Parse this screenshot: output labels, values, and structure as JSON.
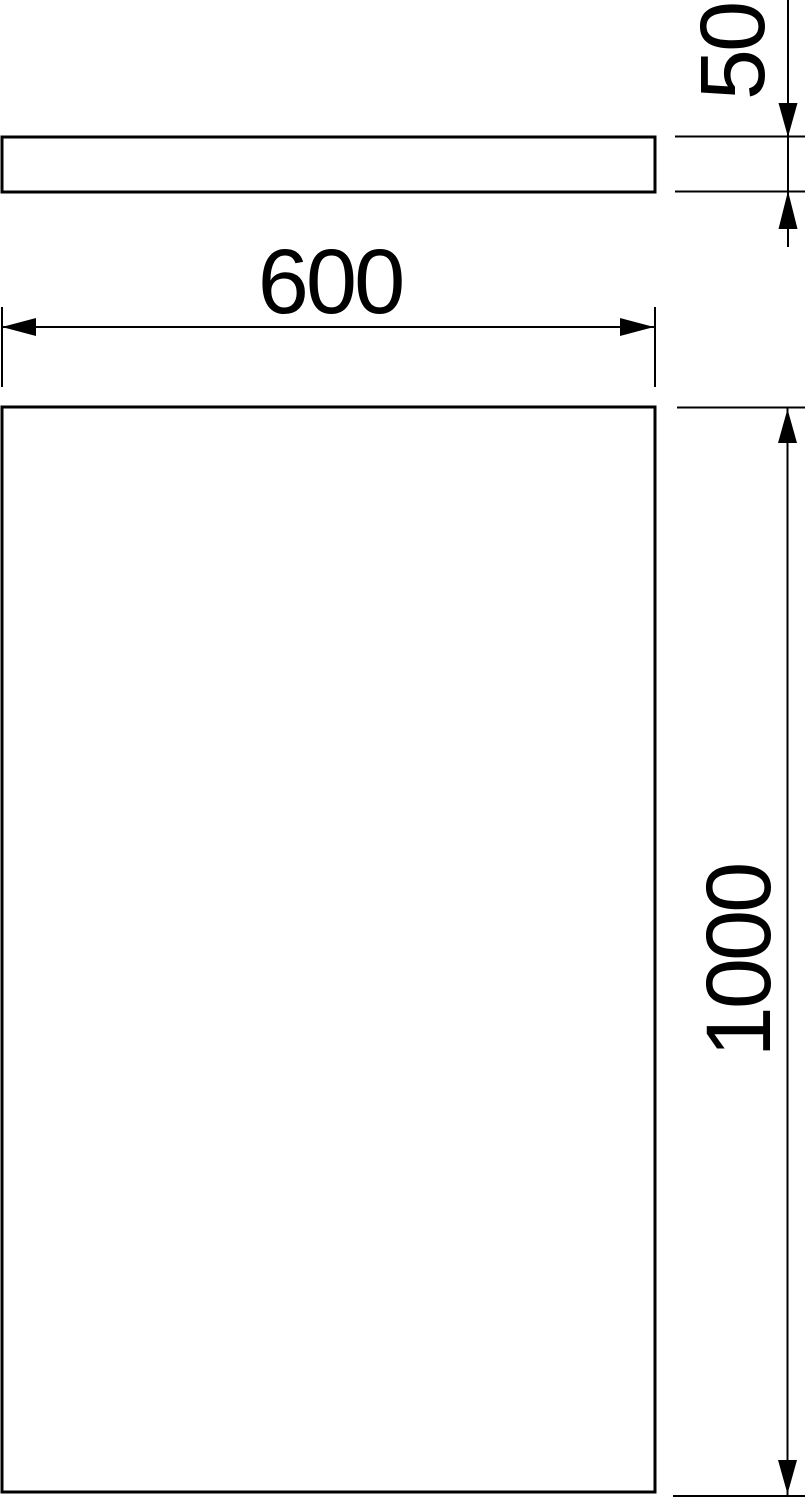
{
  "drawing": {
    "colors": {
      "background": "#ffffff",
      "line": "#000000",
      "text": "#000000"
    },
    "dimensions": {
      "thickness": {
        "label": "50"
      },
      "width": {
        "label": "600"
      },
      "height": {
        "label": "1000"
      }
    }
  }
}
